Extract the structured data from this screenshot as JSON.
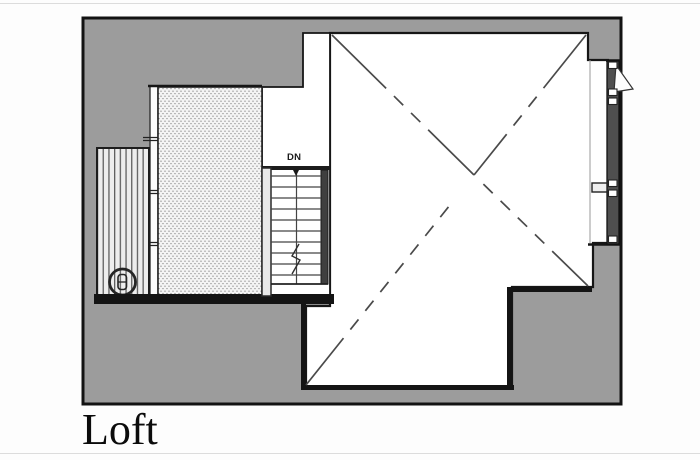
{
  "title": "Loft",
  "plan": {
    "stair_label": "DN",
    "colors": {
      "roof": "#9c9c9c",
      "wall": "#161616",
      "paper": "#fdfdfd",
      "floor": "#ffffff"
    },
    "areas": [
      "open-to-below",
      "loft-floor",
      "deck",
      "stairwell",
      "glazed-wall"
    ]
  }
}
